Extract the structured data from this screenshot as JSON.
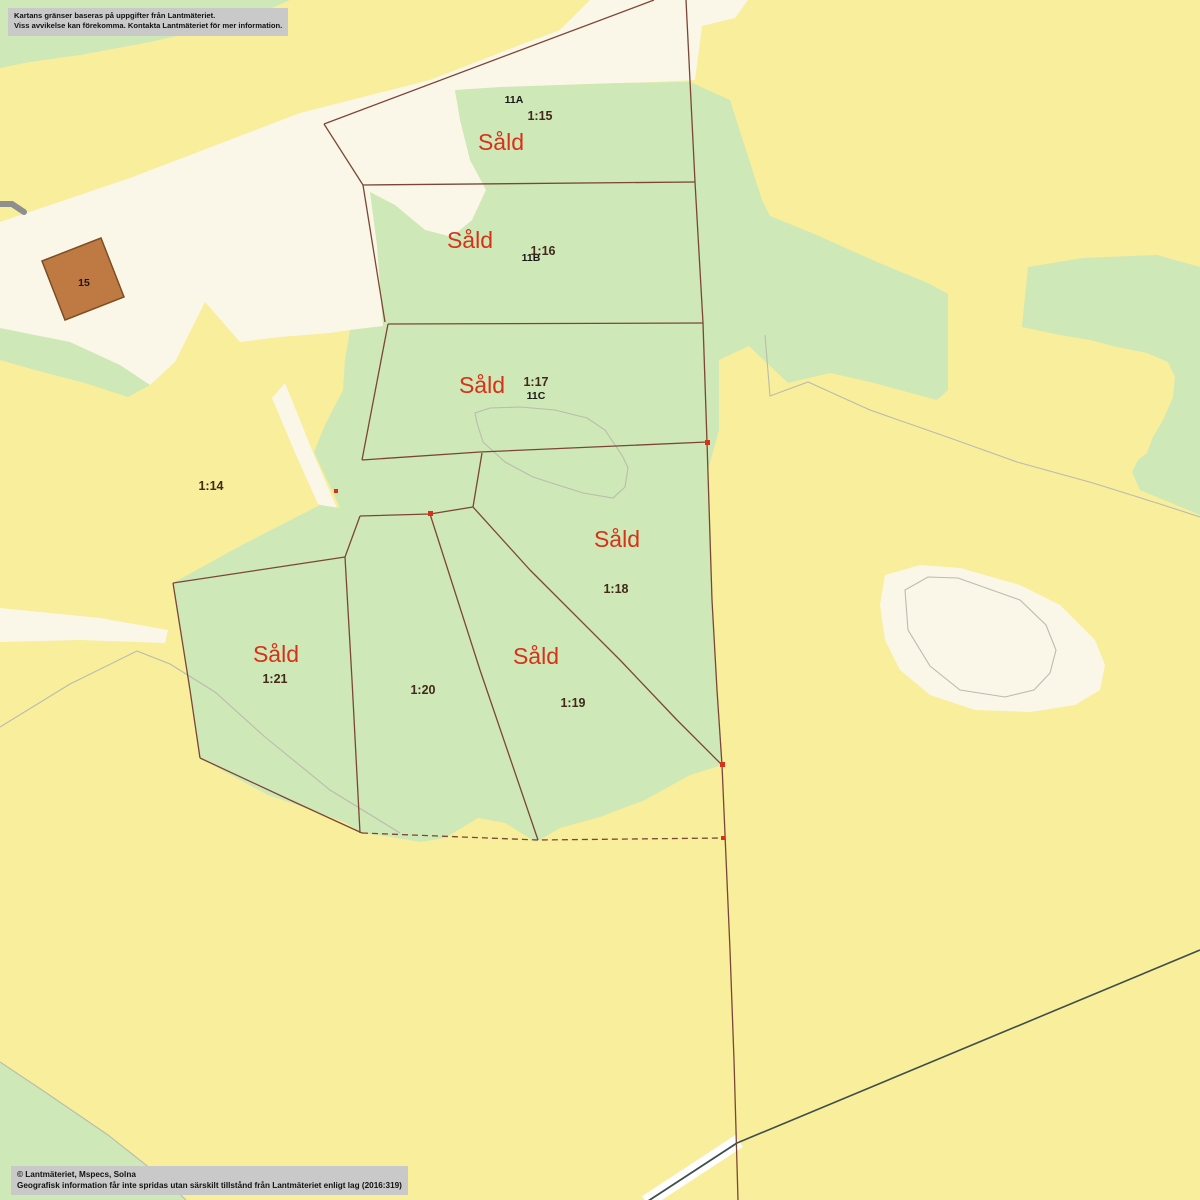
{
  "disclaimer": {
    "line1": "Kartans gränser baseras på uppgifter från Lantmäteriet.",
    "line2": "Viss avvikelse kan förekomma. Kontakta Lantmäteriet för mer information."
  },
  "attribution": {
    "line1": "© Lantmäteriet, Mspecs, Solna",
    "line2": "Geografisk information får inte spridas utan särskilt tillstånd från Lantmäteriet enligt lag (2016:319)"
  },
  "parcels": [
    {
      "id": "1:14"
    },
    {
      "id": "1:15",
      "status": "Såld",
      "building": "11A"
    },
    {
      "id": "1:16",
      "status": "Såld",
      "building": "11B"
    },
    {
      "id": "1:17",
      "status": "Såld",
      "building": "11C"
    },
    {
      "id": "1:18",
      "status": "Såld"
    },
    {
      "id": "1:19",
      "status": "Såld"
    },
    {
      "id": "1:20"
    },
    {
      "id": "1:21",
      "status": "Såld"
    }
  ],
  "buildings": [
    {
      "id": "15"
    }
  ],
  "colors": {
    "field_yellow": "#f8ee9c",
    "forest_green": "#cfe8b7",
    "open_cream": "#faf7e8",
    "boundary_brown": "#7b4636",
    "sold_red": "#d93018",
    "building_fill": "#bf7a44",
    "notice_bg": "#c9c9c9",
    "road_dark": "#3e4f4a"
  }
}
